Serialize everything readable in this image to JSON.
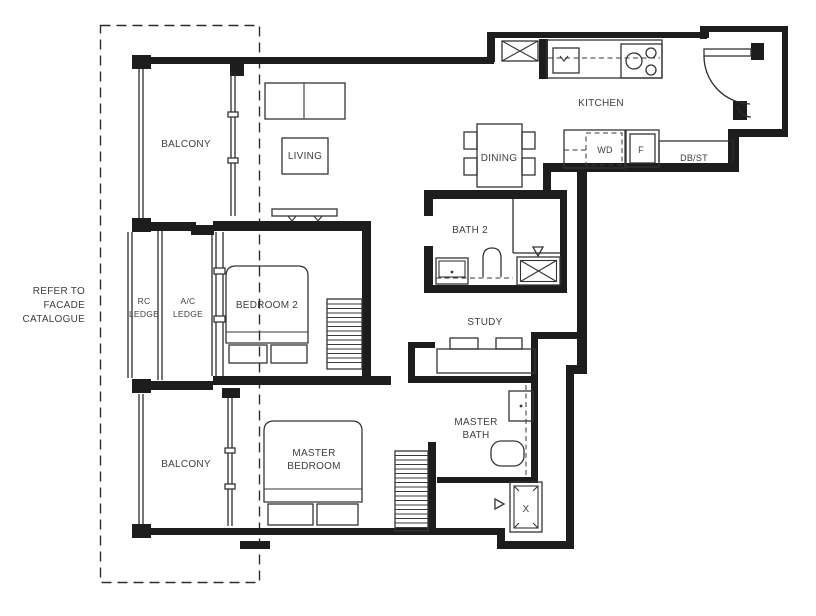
{
  "colors": {
    "wall": "#1d1d1d",
    "line": "#2c2c2c",
    "text": "#3f3f3f",
    "background": "#ffffff"
  },
  "facade_note": [
    "REFER TO",
    "FACADE",
    "CATALOGUE"
  ],
  "rooms": {
    "balcony_top": "BALCONY",
    "living": "LIVING",
    "kitchen": "KITCHEN",
    "dining": "DINING",
    "bath2": "BATH 2",
    "study": "STUDY",
    "bedroom2": "BEDROOM 2",
    "master_bath": [
      "MASTER",
      "BATH"
    ],
    "master_bedroom": [
      "MASTER",
      "BEDROOM"
    ],
    "balcony_bottom": "BALCONY",
    "rc_ledge": [
      "RC",
      "LEDGE"
    ],
    "ac_ledge": [
      "A/C",
      "LEDGE"
    ]
  },
  "labels": {
    "washer_dryer": "WD",
    "fridge": "F",
    "db_st": "DB/ST",
    "shower": "X"
  }
}
